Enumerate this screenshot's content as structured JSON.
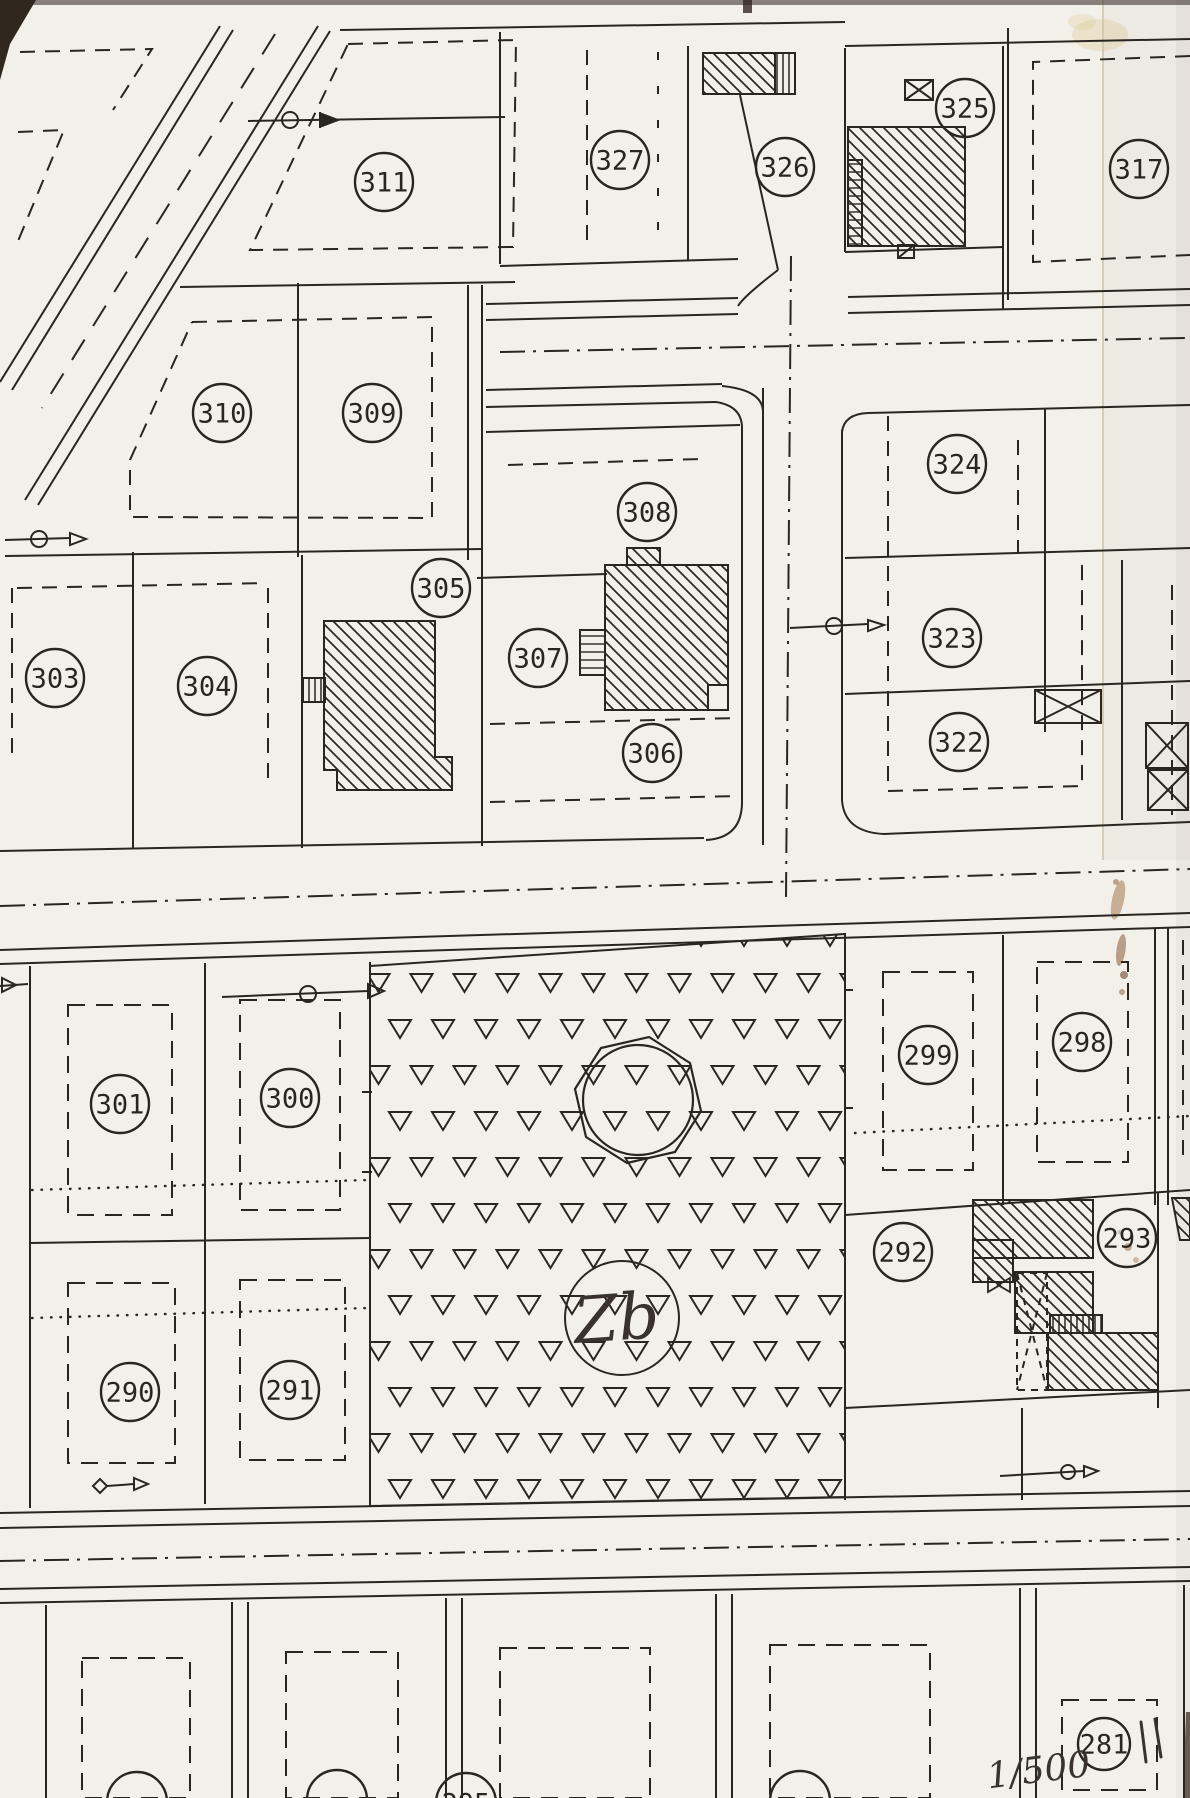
{
  "map": {
    "colors": {
      "paper": "#f3f0ea",
      "ink": "#2b2520",
      "pen": "#3a332c",
      "stain": "#8a5a33"
    },
    "parcel_labels": [
      {
        "label": "311",
        "x": 384,
        "y": 182
      },
      {
        "label": "327",
        "x": 620,
        "y": 160
      },
      {
        "label": "326",
        "x": 785,
        "y": 167
      },
      {
        "label": "325",
        "x": 965,
        "y": 108
      },
      {
        "label": "317",
        "x": 1139,
        "y": 169
      },
      {
        "label": "310",
        "x": 222,
        "y": 413
      },
      {
        "label": "309",
        "x": 372,
        "y": 413
      },
      {
        "label": "308",
        "x": 647,
        "y": 512
      },
      {
        "label": "324",
        "x": 957,
        "y": 464
      },
      {
        "label": "305",
        "x": 441,
        "y": 588
      },
      {
        "label": "303",
        "x": 55,
        "y": 678
      },
      {
        "label": "304",
        "x": 207,
        "y": 686
      },
      {
        "label": "307",
        "x": 538,
        "y": 658
      },
      {
        "label": "323",
        "x": 952,
        "y": 638
      },
      {
        "label": "306",
        "x": 652,
        "y": 753
      },
      {
        "label": "322",
        "x": 959,
        "y": 742
      },
      {
        "label": "301",
        "x": 120,
        "y": 1104
      },
      {
        "label": "300",
        "x": 290,
        "y": 1098
      },
      {
        "label": "299",
        "x": 928,
        "y": 1055
      },
      {
        "label": "298",
        "x": 1082,
        "y": 1042
      },
      {
        "label": "292",
        "x": 903,
        "y": 1252
      },
      {
        "label": "293",
        "x": 1127,
        "y": 1238
      },
      {
        "label": "290",
        "x": 130,
        "y": 1392
      },
      {
        "label": "291",
        "x": 290,
        "y": 1390
      },
      {
        "label": "281",
        "x": 1104,
        "y": 1744,
        "r": 26
      }
    ],
    "partial_labels": [
      {
        "label": "",
        "x": 137,
        "y": 1802
      },
      {
        "label": "",
        "x": 337,
        "y": 1800
      },
      {
        "label": "295",
        "x": 466,
        "y": 1803
      },
      {
        "label": "",
        "x": 800,
        "y": 1801
      }
    ],
    "area_label": {
      "text": "Zb"
    },
    "scale_note": {
      "text": "1/500"
    }
  }
}
